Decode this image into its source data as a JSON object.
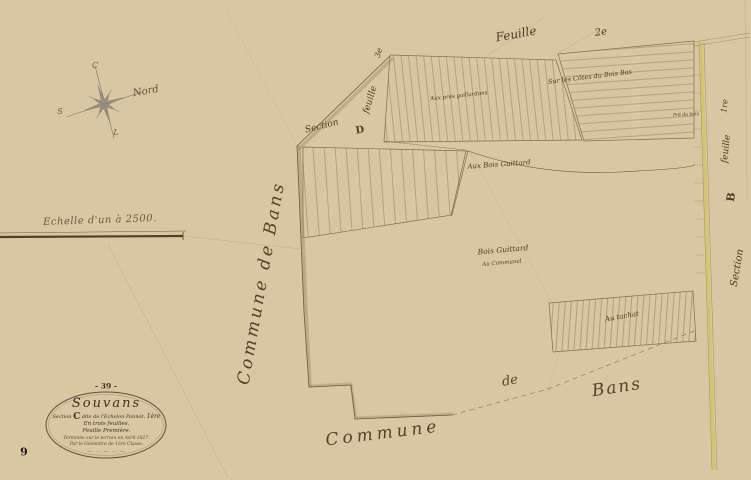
{
  "sheet": {
    "page_number": "9",
    "plate_number": "- 39 -"
  },
  "compass": {
    "north": "Nord",
    "couchant": "C",
    "sud": "S",
    "levant": "L"
  },
  "scale_text": "Echelle d'un à 2500.",
  "cartouche": {
    "title": "Souvans",
    "section_prefix": "Section",
    "section_letter": "C",
    "section_name": "dite de l'Echelon Pannot.",
    "section_sheet": "1ère",
    "sheets_line": "En trois feuilles.",
    "sheet_line": "Feuille Première.",
    "survey_line": "Terminée sur le terrain en Avril 1827.",
    "surveyor_line": "Par le Géomètre de 1ère Classe.",
    "flourish": "— ·· — ·· —"
  },
  "neighbors": {
    "commune_left": "Commune de Bans",
    "commune_bottom_word1": "Commune",
    "commune_bottom_word2": "de",
    "commune_bottom_word3": "Bans",
    "top_sheet_word": "Feuille",
    "top_sheet_num": "2e",
    "west_sheet_word": "feuille",
    "west_sheet_num": "3e",
    "west_section_word": "Section",
    "west_section_letter": "D",
    "east_sheet_word": "feuille",
    "east_sheet_num": "1re",
    "east_section_word": "Section",
    "east_section_letter": "B"
  },
  "lieu_dits": {
    "gaillardons": "Aux prés gaillardons",
    "cotes_bois_bas": "Sur les Côtes du Bois Bas",
    "aux_bois_guittard": "Aux Bois Guittard",
    "bois_guittard": "Bois Guittard",
    "communal": "Au Communal",
    "tachat": "Au tachat",
    "pre_du_bois": "Pré du bois"
  },
  "colors": {
    "paper": "#d8c7a2",
    "ink": "#5d4a33",
    "road_yellow": "#d6c45f"
  }
}
